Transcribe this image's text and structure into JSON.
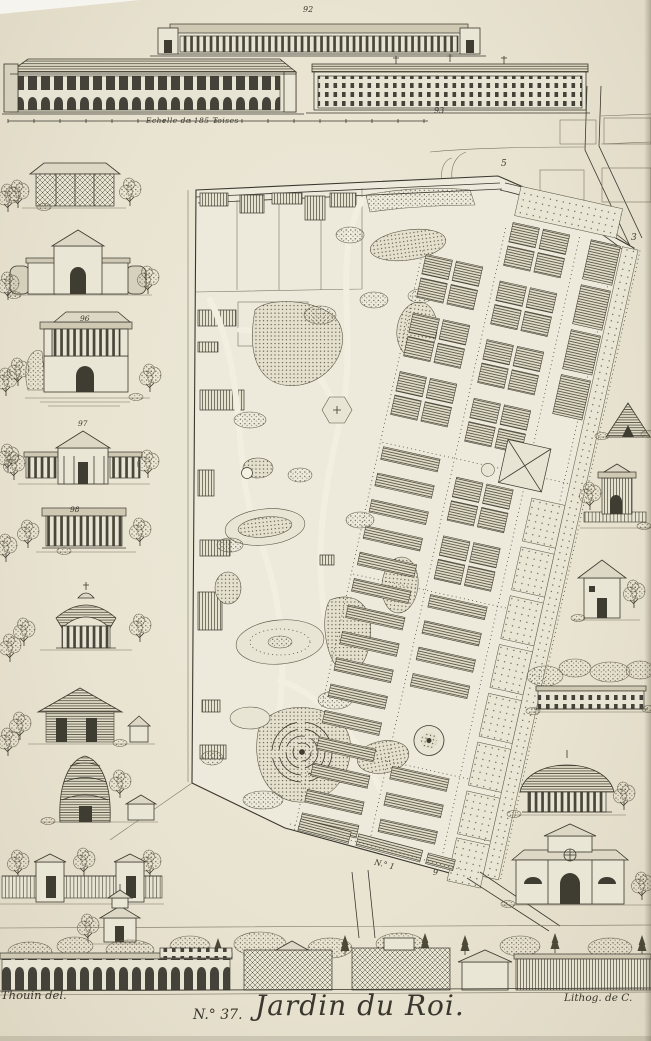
{
  "artwork": {
    "plate_number": "N.° 37.",
    "title": "Jardin du Roi.",
    "credit_left": "Thouin del.",
    "credit_right": "Lithog. de C.",
    "scale_label": "Echelle de 185 Toises"
  },
  "plan_labels": {
    "north_road": "5",
    "east_corner": "3",
    "south_road": "N.° 1",
    "south_gate": "9"
  },
  "figure_labels": {
    "top_gallery": "92",
    "long_building": "93",
    "belvedere": "96",
    "temple": "97",
    "colonnade": "98"
  },
  "scenes": {
    "plan": "tilted-garden-plan-with-formal-parterres-and-winding-english-garden",
    "top_elevations": [
      "gallery-colonnade-elevation",
      "arched-greenhouse-elevation",
      "long-dormitory-elevation"
    ],
    "left_column": [
      "trellis-pavilion",
      "winged-pavilion",
      "belvedere-over-grotto",
      "pedimented-temple",
      "open-colonnade",
      "round-thatched-kiosk",
      "log-cabin",
      "beehive-icehouse",
      "fence-with-gate-pavilions",
      "pagoda-tower"
    ],
    "right_column": [
      "pyramid-lodge",
      "rustic-kiosk",
      "square-hut",
      "orangery-range",
      "round-thatched-pavilion",
      "country-house"
    ],
    "bottom_strip": [
      "curved-arcade-range",
      "trellis-pavilions",
      "glasshouse-range"
    ]
  },
  "colors": {
    "paper": "#ebe7d7",
    "ink": "#3a372e",
    "ink_light": "#7a7462"
  }
}
